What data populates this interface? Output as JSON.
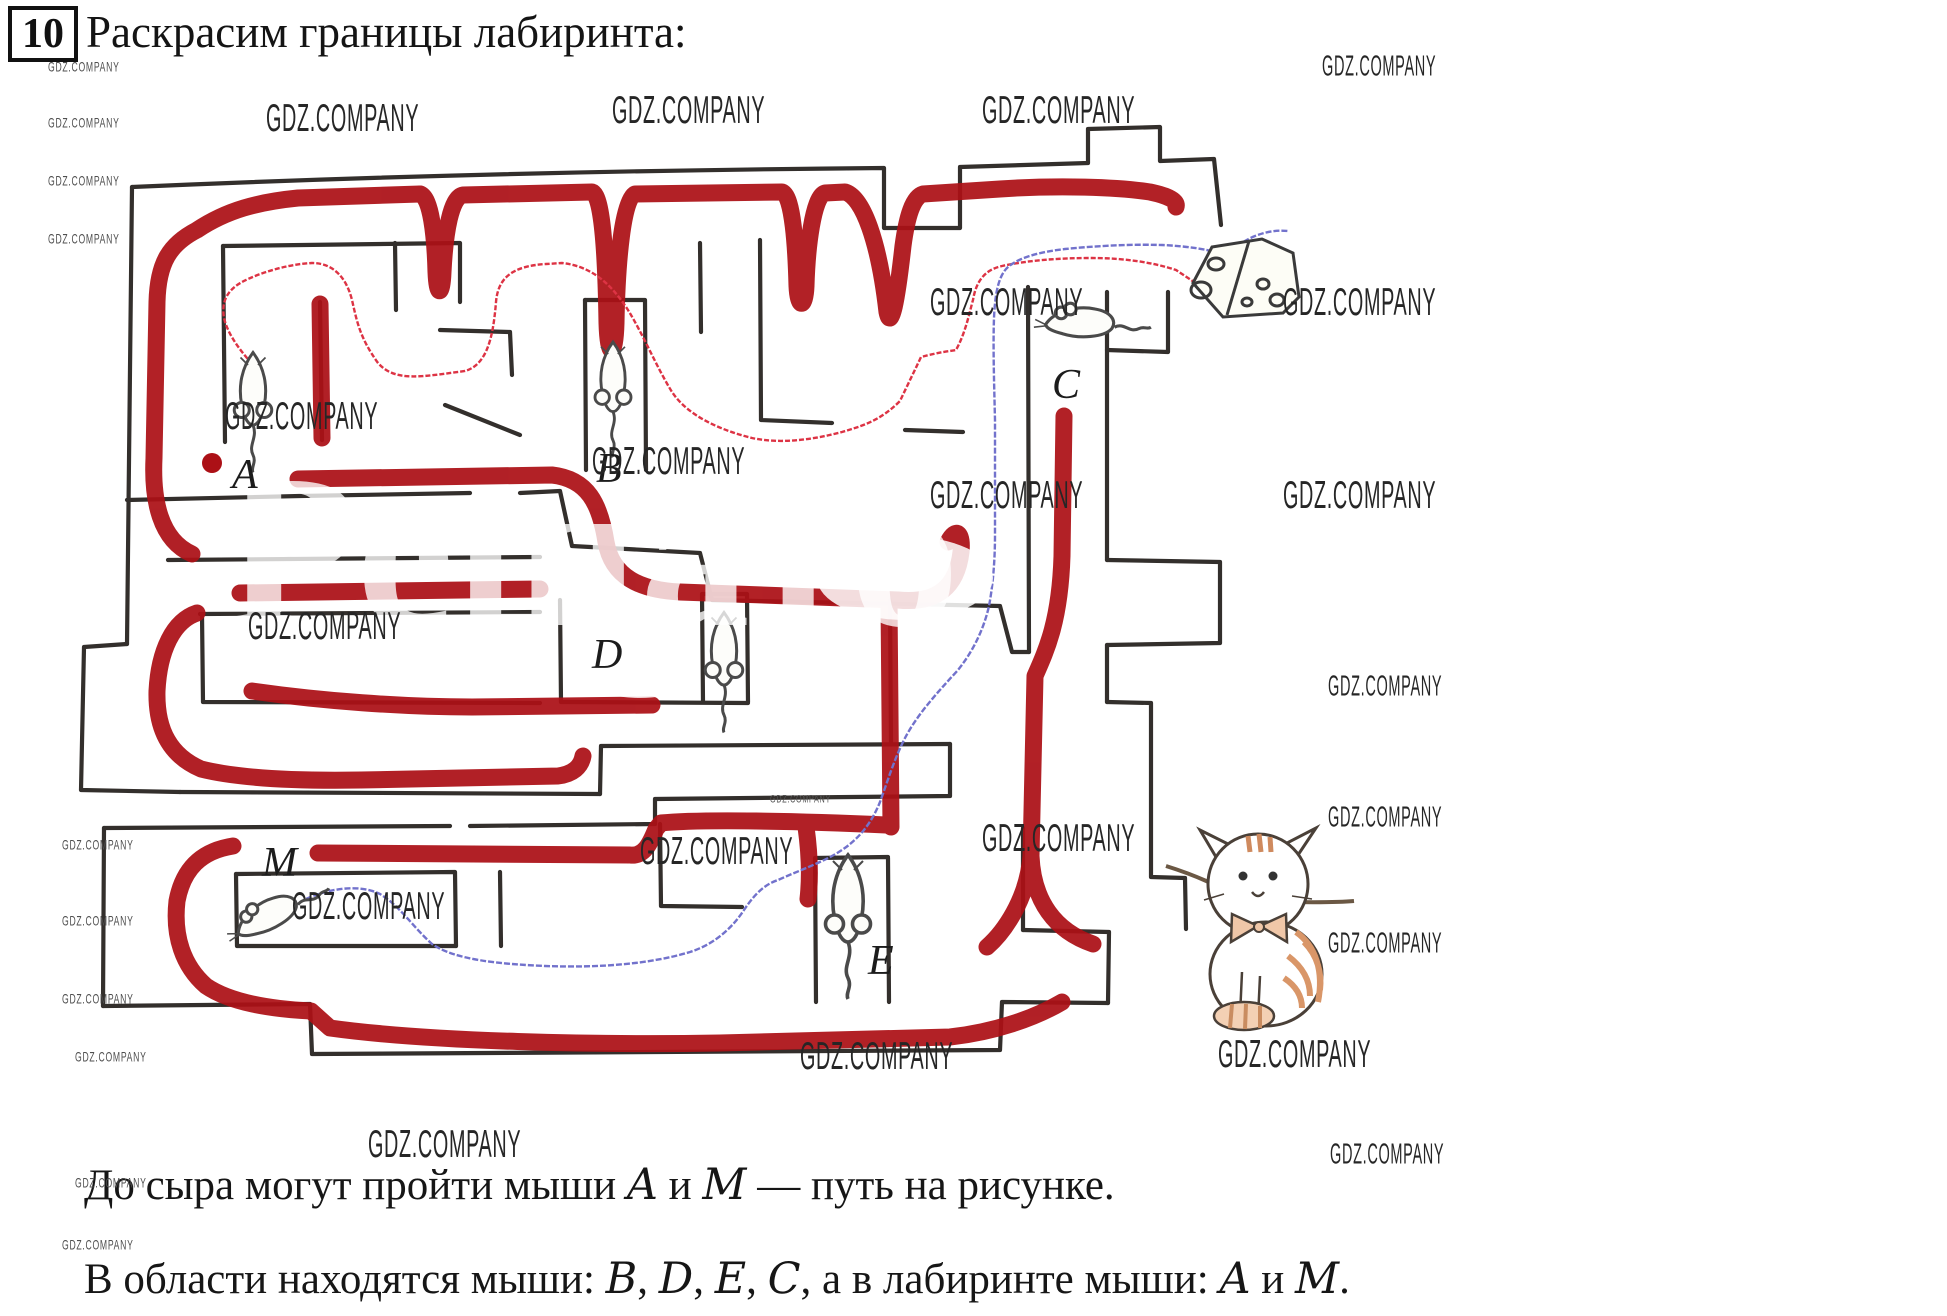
{
  "problem": {
    "number": "10",
    "title": "Раскрасим границы лабиринта:"
  },
  "watermark": {
    "text": "GDZ.COMPANY",
    "ghost_text": "Решато"
  },
  "figure": {
    "type": "maze",
    "description": "Лабиринт с раскрашенными границами, мышами, сыром и котом",
    "labels": {
      "a": "A",
      "b": "B",
      "c": "C",
      "d": "D",
      "e": "E",
      "m": "M"
    },
    "icons": [
      "mouse-a",
      "mouse-b",
      "mouse-c",
      "mouse-d",
      "mouse-e",
      "mouse-m",
      "cheese",
      "cat"
    ],
    "colors": {
      "boundary_paint": "#ac1016",
      "path_mouse_a": "#dd3344",
      "path_mouse_m": "#7272cc",
      "walls": "#332f2c"
    }
  },
  "answer": {
    "line1_parts": [
      {
        "t": "До сыра могут пройти мыши "
      },
      {
        "t": "A",
        "i": true
      },
      {
        "t": " и "
      },
      {
        "t": "M",
        "i": true
      },
      {
        "t": " — путь на рисунке."
      }
    ],
    "line2_parts": [
      {
        "t": "В области находятся мыши: "
      },
      {
        "t": "B",
        "i": true
      },
      {
        "t": ", "
      },
      {
        "t": "D",
        "i": true
      },
      {
        "t": ", "
      },
      {
        "t": "E",
        "i": true
      },
      {
        "t": ", "
      },
      {
        "t": "C",
        "i": true
      },
      {
        "t": ", а в лабиринте мыши: "
      },
      {
        "t": "A",
        "i": true
      },
      {
        "t": " и "
      },
      {
        "t": "M",
        "i": true
      },
      {
        "t": "."
      }
    ]
  }
}
